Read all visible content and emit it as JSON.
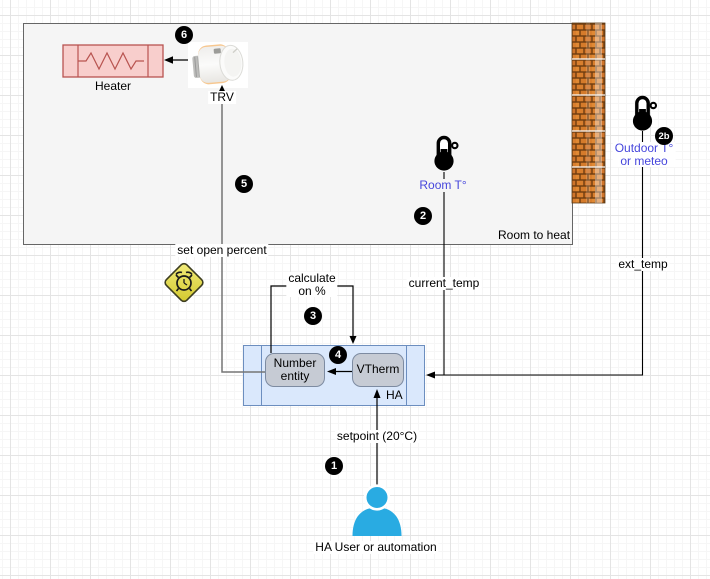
{
  "nodes": {
    "room": {
      "label": "Room to heat"
    },
    "heater": {
      "label": "Heater"
    },
    "trv": {
      "label": "TRV"
    },
    "room_sensor": {
      "label": "Room T°"
    },
    "outdoor_sensor": {
      "line1": "Outdoor T°",
      "line2": "or meteo"
    },
    "ha": {
      "label": "HA"
    },
    "number_entity": {
      "label": "Number entity"
    },
    "vtherm": {
      "label": "VTherm"
    },
    "user": {
      "label": "HA User or automation"
    }
  },
  "edges": {
    "set_open_percent": {
      "label": "set open percent"
    },
    "calculate": {
      "line1": "calculate",
      "line2": "on %"
    },
    "current_temp": {
      "label": "current_temp"
    },
    "ext_temp": {
      "label": "ext_temp"
    },
    "setpoint": {
      "label": "setpoint (20°C)"
    }
  },
  "badges": {
    "b1": "1",
    "b2": "2",
    "b2b": "2b",
    "b3": "3",
    "b4": "4",
    "b5": "5",
    "b6": "6"
  },
  "colors": {
    "heater_fill": "#f8cecc",
    "heater_stroke": "#b85450",
    "ha_fill": "#dae8fc",
    "ha_stroke": "#6c8ebf",
    "entity_fill": "#c6cbd4",
    "entity_stroke": "#7d8ba1",
    "room_fill": "#f5f5f5",
    "room_stroke": "#666666",
    "sensor_label_text": "#4646dc",
    "person": "#29abe2",
    "alarm_diamond": "#e8e04a",
    "brick": "#d97f2e",
    "badge_bg": "#000000"
  }
}
